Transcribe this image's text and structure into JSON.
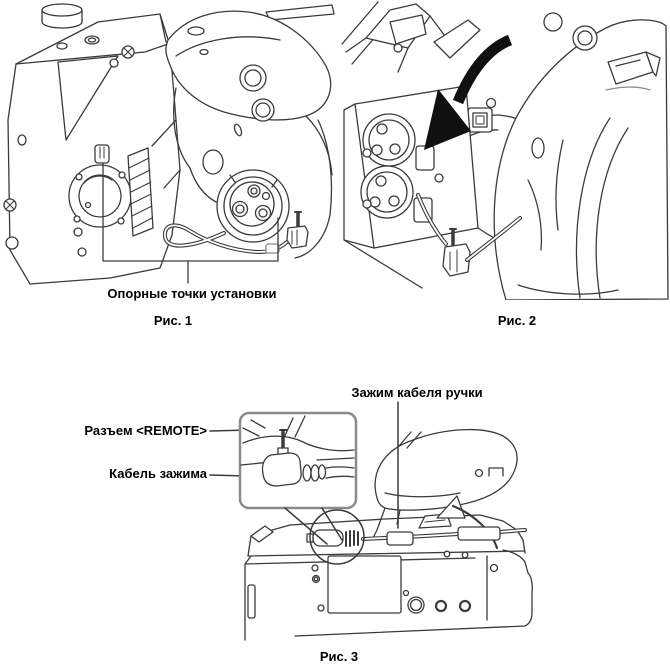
{
  "page": {
    "background": "#ffffff",
    "line_color": "#3b3b3b",
    "text_color": "#000000",
    "inset_border_color": "#8a8a8a",
    "arrow_color": "#111111"
  },
  "figure1": {
    "caption": "Рис. 1",
    "label_mounting_points": "Опорные точки установки"
  },
  "figure2": {
    "caption": "Рис. 2"
  },
  "figure3": {
    "caption": "Рис. 3",
    "label_handle_cable_clamp": "Зажим кабеля ручки",
    "label_remote_connector": "Разъем <REMOTE>",
    "label_clamp_cable": "Кабель зажима"
  }
}
